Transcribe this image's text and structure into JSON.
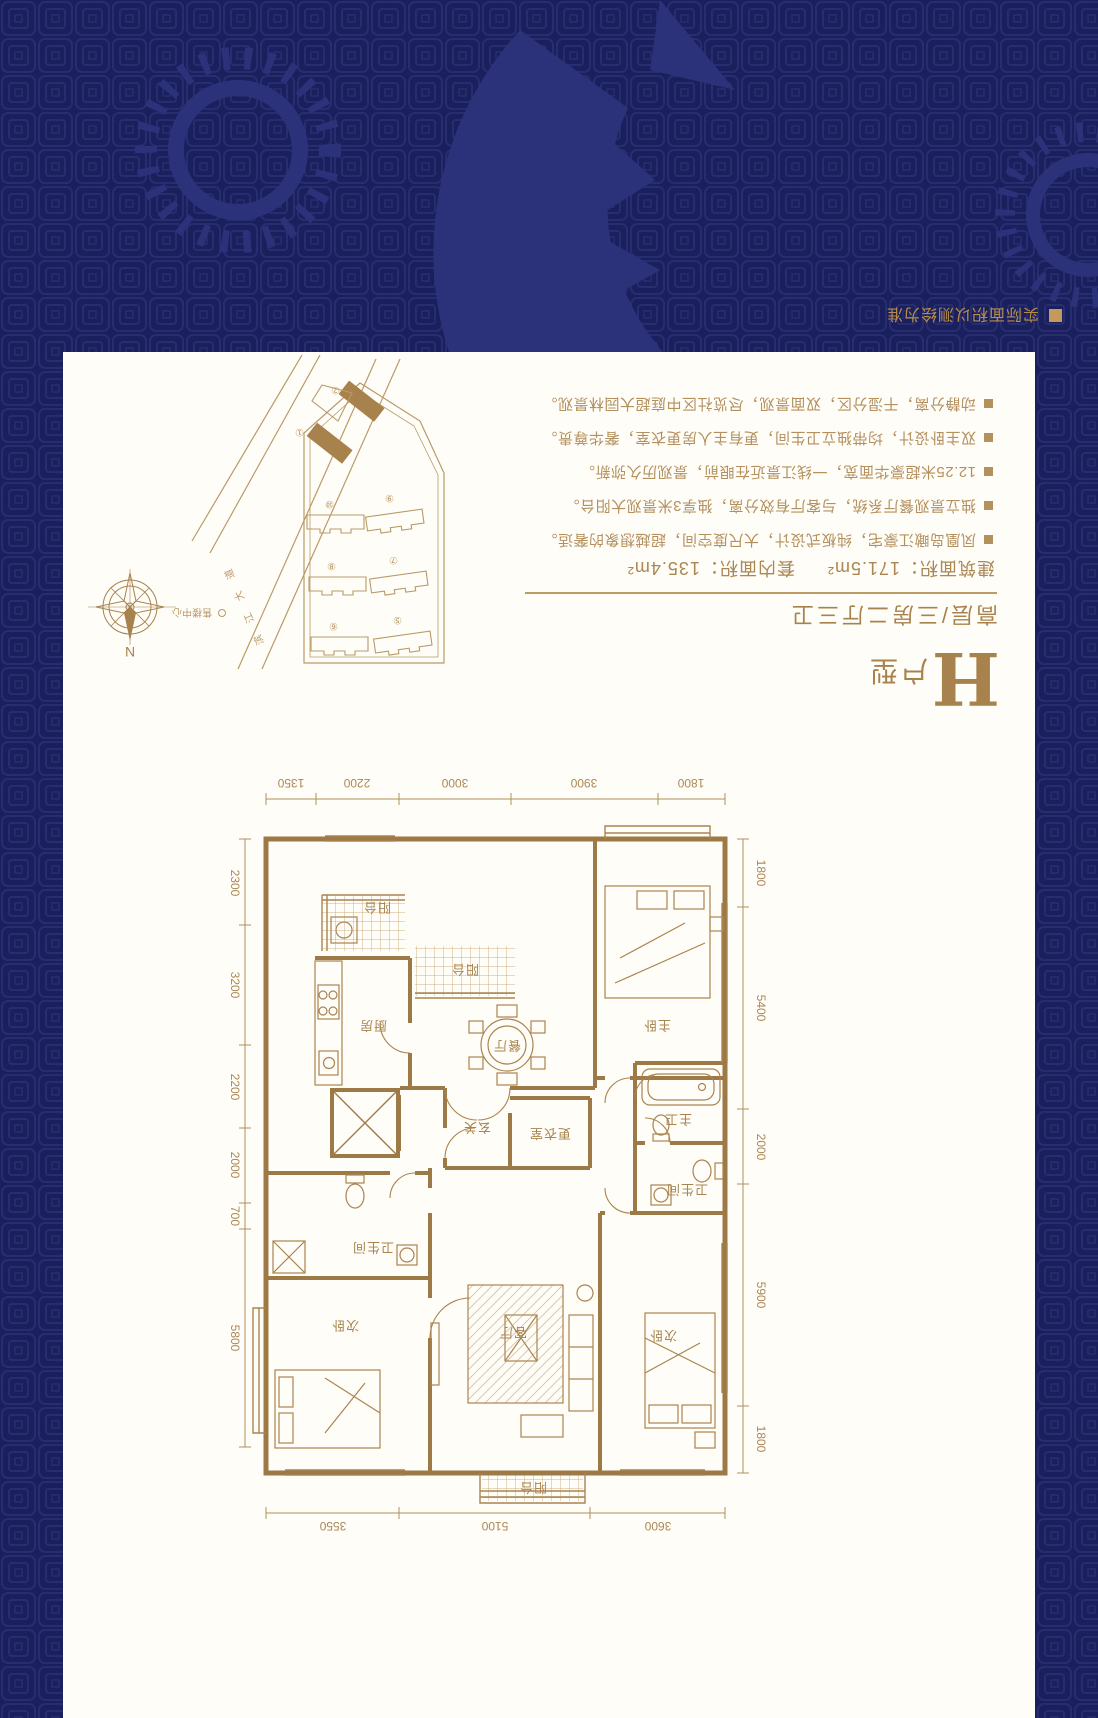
{
  "page": {
    "disclaimer": "实际面积以测绘为准"
  },
  "unit_info": {
    "title_letter": "H",
    "title_suffix": "户型",
    "subtitle": "高层/三房二厅三卫",
    "area": {
      "built_label": "建筑面积：",
      "built_value": "171.5m²",
      "inner_label": "套内面积：",
      "inner_value": "135.4m²"
    },
    "features": [
      "凤凰岛瞰江豪宅，纯板式设计，大尺度空间，超越想象的奢适。",
      "独立景观餐厅系统，与客厅有效分离，独享3米景观大阳台。",
      "12.25米超豪华面宽，一线江景近在眼前，景观历久弥新。",
      "双主卧设计，均带独立卫生间，更有主人房更衣室，奢华尊贵。",
      "动静分离，干湿分区，双面景观，尽览社区中庭超大园林景观。"
    ]
  },
  "floor_plan": {
    "rooms": {
      "living": "客厅",
      "dining": "餐厅",
      "kitchen": "厨房",
      "foyer": "玄关",
      "dressing": "更衣室",
      "master_bedroom": "主卧",
      "bedroom_tl": "次卧",
      "bedroom_tr": "次卧",
      "master_bath": "主卫",
      "bath_left": "卫生间",
      "bath_tr": "卫生间",
      "balcony_top": "阳台",
      "balcony_mid": "阳台",
      "balcony_service": "阳台"
    },
    "dimensions": {
      "top": [
        "3600",
        "5100",
        "3550"
      ],
      "bottom": [
        "1800",
        "3900",
        "3000",
        "2200",
        "1350"
      ],
      "left": [
        "1800",
        "5900",
        "2000",
        "5400",
        "1800"
      ],
      "right": [
        "5800",
        "700",
        "2000",
        "2200",
        "3200",
        "2300"
      ]
    }
  },
  "site_plan": {
    "north_label": "N",
    "road_name": "滨江大道",
    "sales_center": "售楼中心",
    "building_numbers": [
      "⑤",
      "⑥",
      "⑦",
      "⑧",
      "⑨",
      "⑩",
      "①",
      "②"
    ]
  },
  "colors": {
    "navy": "#1a1f5d",
    "gold": "#aa8450",
    "card": "#fffdf8"
  }
}
